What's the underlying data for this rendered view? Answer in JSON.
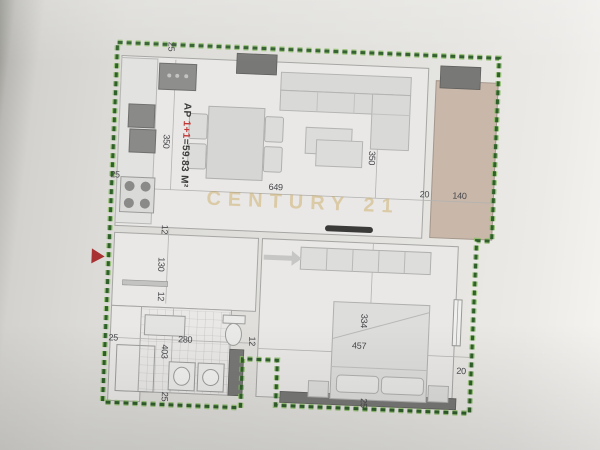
{
  "document": {
    "watermark": "CENTURY 21",
    "apartment_label": {
      "prefix": "AP ",
      "unit": "1+1",
      "area": "=59.83 M²"
    }
  },
  "dimensions": [
    {
      "text": "25",
      "x": 67,
      "y": 17,
      "rot": 1
    },
    {
      "text": "25",
      "x": 16,
      "y": 147,
      "rot": 0
    },
    {
      "text": "350",
      "x": 66,
      "y": 112,
      "rot": 1
    },
    {
      "text": "649",
      "x": 177,
      "y": 153,
      "rot": 0
    },
    {
      "text": "350",
      "x": 272,
      "y": 120,
      "rot": 1
    },
    {
      "text": "20",
      "x": 326,
      "y": 154,
      "rot": 0
    },
    {
      "text": "140",
      "x": 361,
      "y": 154,
      "rot": 0
    },
    {
      "text": "12",
      "x": 68,
      "y": 200,
      "rot": 1
    },
    {
      "text": "130",
      "x": 66,
      "y": 235,
      "rot": 1
    },
    {
      "text": "12",
      "x": 67,
      "y": 267,
      "rot": 1
    },
    {
      "text": "25",
      "x": 21,
      "y": 310,
      "rot": 0
    },
    {
      "text": "280",
      "x": 93,
      "y": 309,
      "rot": 0
    },
    {
      "text": "12",
      "x": 160,
      "y": 308,
      "rot": 1
    },
    {
      "text": "403",
      "x": 73,
      "y": 322,
      "rot": 1
    },
    {
      "text": "25",
      "x": 75,
      "y": 367,
      "rot": 1
    },
    {
      "text": "334",
      "x": 271,
      "y": 283,
      "rot": 1
    },
    {
      "text": "457",
      "x": 267,
      "y": 308,
      "rot": 0
    },
    {
      "text": "20",
      "x": 370,
      "y": 329,
      "rot": 0
    },
    {
      "text": "25",
      "x": 274,
      "y": 365,
      "rot": 1
    }
  ],
  "colors": {
    "boundary_green_dark": "#2f5f2a",
    "boundary_green_light": "#8dbd6a",
    "entry_arrow_red": "#a83232",
    "area_red": "#c23535",
    "balcony_beige": "#c9b7aa",
    "watermark_gold": "#c7a14f"
  }
}
